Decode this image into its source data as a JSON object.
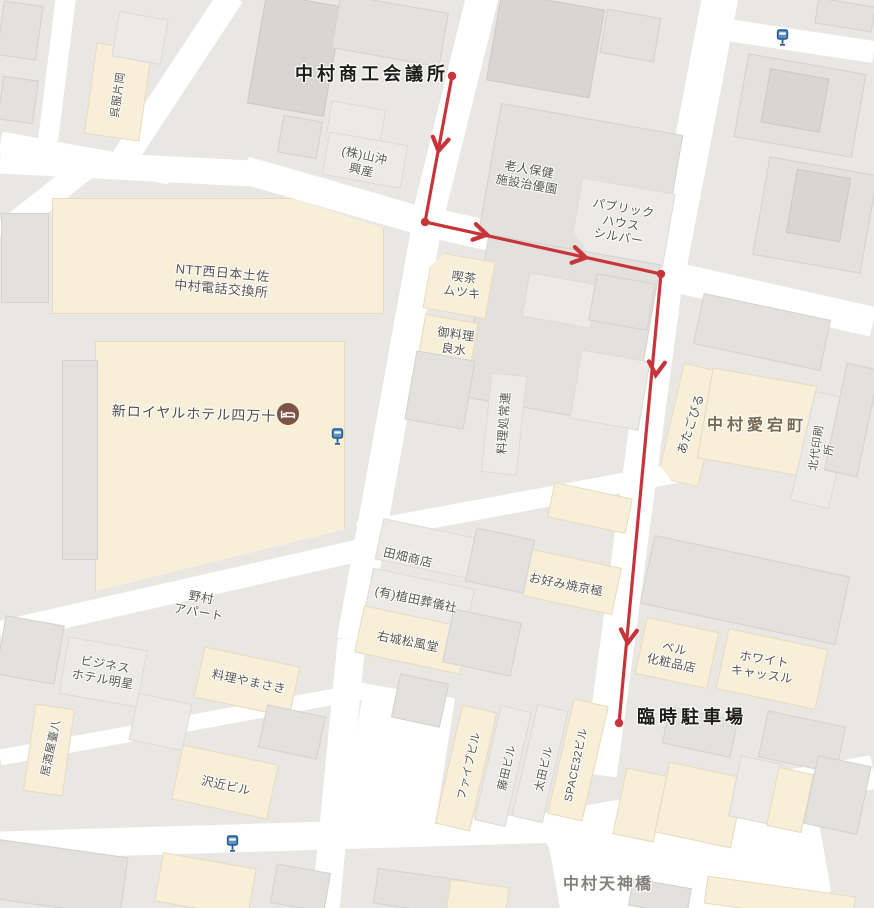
{
  "map_labels": {
    "gofuku": {
      "text": "呉服片岡"
    },
    "chamber": {
      "text": "中村商工会議所"
    },
    "yamaoki": {
      "text": "(株)山沖\n興産"
    },
    "rojin": {
      "text": "老人保健\n施設治優園"
    },
    "public_house": {
      "text": "パブリック\nハウス\nシルバー"
    },
    "ntt": {
      "text": "NTT西日本土佐\n中村電話交換所"
    },
    "kissa": {
      "text": "喫茶\nムツキ"
    },
    "oryori": {
      "text": "御料理\n良水"
    },
    "ryori_dokoro": {
      "text": "料理処常連"
    },
    "hotel": {
      "text": "新ロイヤルホテル四万十"
    },
    "atago_building": {
      "text": "あたごびる"
    },
    "atago_town": {
      "text": "中村愛宕町"
    },
    "kitadai": {
      "text": "北代印刷所"
    },
    "tabata": {
      "text": "田畑商店"
    },
    "ueda": {
      "text": "(有)植田葬儀社"
    },
    "okonomiyaki": {
      "text": "お好み焼京極"
    },
    "ujo": {
      "text": "右城松風堂"
    },
    "nomura": {
      "text": "野村\nアパート"
    },
    "business_hotel": {
      "text": "ビジネス\nホテル明星"
    },
    "yamasaki": {
      "text": "料理やまさき"
    },
    "izakaya": {
      "text": "居酒屋臺八"
    },
    "sawachika": {
      "text": "沢近ビル"
    },
    "five_building": {
      "text": "ファイブビル"
    },
    "fujita": {
      "text": "藤田ビル"
    },
    "ota": {
      "text": "太田ビル"
    },
    "space32": {
      "text": "SPACE32ビル"
    },
    "bell": {
      "text": "ベル\n化粧品店"
    },
    "white_castle": {
      "text": "ホワイト\nキャッスル"
    },
    "parking": {
      "text": "臨時駐車場"
    },
    "tenjin_bridge": {
      "text": "中村天神橋"
    }
  },
  "route": {
    "start_label": "中村商工会議所",
    "end_label": "臨時駐車場",
    "color": "#c7353b",
    "line_width": 3.2,
    "points": [
      [
        452,
        76
      ],
      [
        425,
        222
      ],
      [
        661,
        274
      ],
      [
        619,
        723
      ]
    ],
    "dots": [
      [
        452,
        76
      ],
      [
        425,
        222
      ],
      [
        661,
        274
      ],
      [
        619,
        723
      ]
    ],
    "arrows": [
      {
        "x": 439,
        "y": 148,
        "angle": 100
      },
      {
        "x": 484,
        "y": 234,
        "angle": 12
      },
      {
        "x": 583,
        "y": 257,
        "angle": 12
      },
      {
        "x": 656,
        "y": 372,
        "angle": 95
      },
      {
        "x": 628,
        "y": 640,
        "angle": 95
      }
    ]
  },
  "icons": {
    "transit_stop": "transit-stop-icon",
    "hotel_bed": "hotel-bed-icon"
  },
  "colors": {
    "road": "#ffffff",
    "block": "#e9e7e4",
    "building_grey": "#e3e1de",
    "building_dark": "#d8d6d3",
    "building_light": "#eceae7",
    "poi_building_cream": "#f8efd9",
    "route_red": "#c7353b",
    "transit_blue": "#5b93c8",
    "hotel_icon_brown": "#7b5347"
  }
}
